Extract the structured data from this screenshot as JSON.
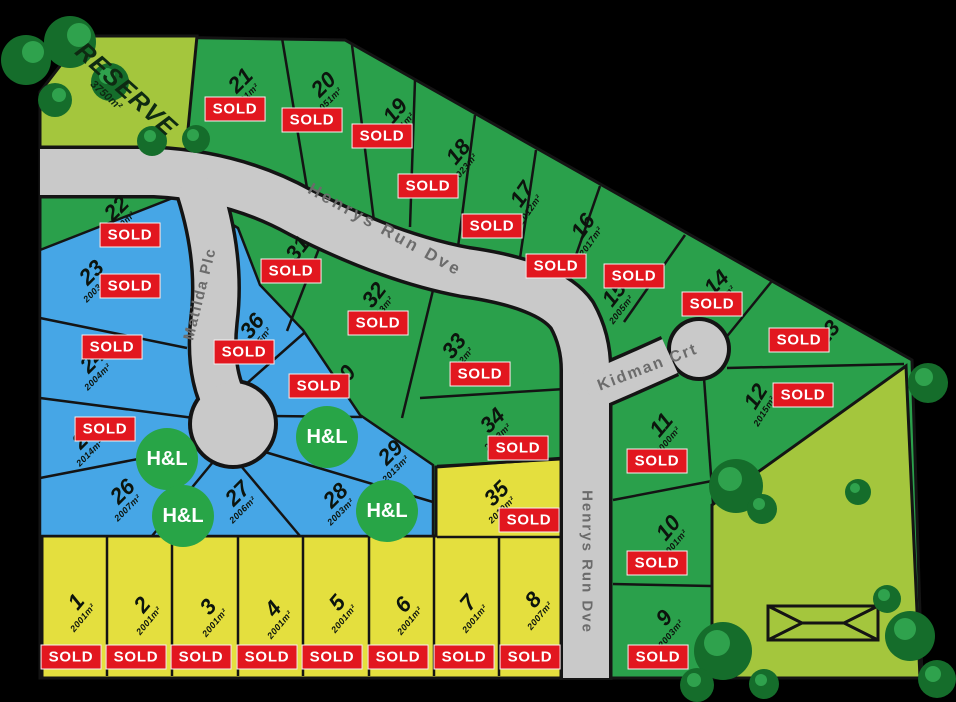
{
  "map": {
    "background": "#000000",
    "colors": {
      "green_lot": "#2aa04b",
      "blue_lot": "#46a6e6",
      "yellow_lot": "#e4df3e",
      "reserve_green": "#a4c63d",
      "road_gray": "#c9c9c9",
      "sold_red": "#e2171f",
      "hl_green": "#28a547"
    },
    "reserve": {
      "label": "RESERVE",
      "area": "3750m²"
    },
    "roads": [
      {
        "name": "Henrys Run Dve"
      },
      {
        "name": "Matilda Plc"
      },
      {
        "name": "Kidman Crt"
      },
      {
        "name": "Henrys Run Dve"
      }
    ],
    "badges": {
      "sold_label": "SOLD",
      "hl_label": "H&L"
    },
    "lots": [
      {
        "num": "1",
        "area": "2001m²",
        "zone": "yellow",
        "sold": true,
        "label": {
          "x": 80,
          "y": 605,
          "rot": -50
        },
        "sold_badge": {
          "x": 71,
          "y": 657
        }
      },
      {
        "num": "2",
        "area": "2001m²",
        "zone": "yellow",
        "sold": true,
        "label": {
          "x": 146,
          "y": 608,
          "rot": -50
        },
        "sold_badge": {
          "x": 136,
          "y": 657
        }
      },
      {
        "num": "3",
        "area": "2001m²",
        "zone": "yellow",
        "sold": true,
        "label": {
          "x": 212,
          "y": 610,
          "rot": -50
        },
        "sold_badge": {
          "x": 201,
          "y": 657
        }
      },
      {
        "num": "4",
        "area": "2001m²",
        "zone": "yellow",
        "sold": true,
        "label": {
          "x": 277,
          "y": 612,
          "rot": -50
        },
        "sold_badge": {
          "x": 267,
          "y": 657
        }
      },
      {
        "num": "5",
        "area": "2001m²",
        "zone": "yellow",
        "sold": true,
        "label": {
          "x": 341,
          "y": 606,
          "rot": -50
        },
        "sold_badge": {
          "x": 332,
          "y": 657
        }
      },
      {
        "num": "6",
        "area": "2001m²",
        "zone": "yellow",
        "sold": true,
        "label": {
          "x": 407,
          "y": 608,
          "rot": -50
        },
        "sold_badge": {
          "x": 398,
          "y": 657
        }
      },
      {
        "num": "7",
        "area": "2001m²",
        "zone": "yellow",
        "sold": true,
        "label": {
          "x": 472,
          "y": 606,
          "rot": -50
        },
        "sold_badge": {
          "x": 464,
          "y": 657
        }
      },
      {
        "num": "8",
        "area": "2007m²",
        "zone": "yellow",
        "sold": true,
        "label": {
          "x": 537,
          "y": 603,
          "rot": -50
        },
        "sold_badge": {
          "x": 530,
          "y": 657
        }
      },
      {
        "num": "9",
        "area": "2003m²",
        "zone": "green",
        "sold": true,
        "label": {
          "x": 668,
          "y": 621,
          "rot": -50
        },
        "sold_badge": {
          "x": 658,
          "y": 657
        }
      },
      {
        "num": "10",
        "area": "2001m²",
        "zone": "green",
        "sold": true,
        "label": {
          "x": 672,
          "y": 531,
          "rot": -50
        },
        "sold_badge": {
          "x": 657,
          "y": 563
        }
      },
      {
        "num": "11",
        "area": "2000m²",
        "zone": "green",
        "sold": true,
        "label": {
          "x": 665,
          "y": 428,
          "rot": -50
        },
        "sold_badge": {
          "x": 657,
          "y": 461
        }
      },
      {
        "num": "12",
        "area": "2015m²",
        "zone": "green",
        "sold": true,
        "label": {
          "x": 760,
          "y": 399,
          "rot": -58
        },
        "sold_badge": {
          "x": 803,
          "y": 395
        }
      },
      {
        "num": "13",
        "area": null,
        "zone": "green",
        "sold": true,
        "label": {
          "x": 828,
          "y": 333,
          "rot": -50
        },
        "sold_badge": {
          "x": 799,
          "y": 340
        }
      },
      {
        "num": "14",
        "area": "2003m²",
        "zone": "green",
        "sold": true,
        "label": {
          "x": 720,
          "y": 286,
          "rot": -45
        },
        "sold_badge": {
          "x": 712,
          "y": 304
        }
      },
      {
        "num": "15",
        "area": "2005m²",
        "zone": "green",
        "sold": true,
        "label": {
          "x": 618,
          "y": 297,
          "rot": -52
        },
        "sold_badge": {
          "x": 634,
          "y": 276
        }
      },
      {
        "num": "16",
        "area": "2017m²",
        "zone": "green",
        "sold": true,
        "label": {
          "x": 587,
          "y": 229,
          "rot": -55
        },
        "sold_badge": {
          "x": 556,
          "y": 266
        }
      },
      {
        "num": "17",
        "area": "2012m²",
        "zone": "green",
        "sold": true,
        "label": {
          "x": 526,
          "y": 197,
          "rot": -55
        },
        "sold_badge": {
          "x": 492,
          "y": 226
        }
      },
      {
        "num": "18",
        "area": "2023m²",
        "zone": "green",
        "sold": true,
        "label": {
          "x": 462,
          "y": 155,
          "rot": -50
        },
        "sold_badge": {
          "x": 428,
          "y": 186
        }
      },
      {
        "num": "19",
        "area": "2021m²",
        "zone": "green",
        "sold": true,
        "label": {
          "x": 399,
          "y": 114,
          "rot": -50
        },
        "sold_badge": {
          "x": 382,
          "y": 136
        }
      },
      {
        "num": "20",
        "area": "2051m²",
        "zone": "green",
        "sold": true,
        "label": {
          "x": 327,
          "y": 88,
          "rot": -45
        },
        "sold_badge": {
          "x": 312,
          "y": 120
        }
      },
      {
        "num": "21",
        "area": "2001m²",
        "zone": "green",
        "sold": true,
        "label": {
          "x": 244,
          "y": 84,
          "rot": -45
        },
        "sold_badge": {
          "x": 235,
          "y": 109
        }
      },
      {
        "num": "22",
        "area": "2010m²",
        "zone": "green",
        "sold": true,
        "label": {
          "x": 120,
          "y": 212,
          "rot": -45
        },
        "sold_badge": {
          "x": 130,
          "y": 235
        }
      },
      {
        "num": "23",
        "area": "2003m²",
        "zone": "blue",
        "sold": true,
        "label": {
          "x": 95,
          "y": 276,
          "rot": -45
        },
        "sold_badge": {
          "x": 130,
          "y": 286
        }
      },
      {
        "num": "24",
        "area": "2004m²",
        "zone": "blue",
        "sold": true,
        "label": {
          "x": 96,
          "y": 364,
          "rot": -45
        },
        "sold_badge": {
          "x": 112,
          "y": 347
        }
      },
      {
        "num": "25",
        "area": "2014m²",
        "zone": "blue",
        "sold": true,
        "label": {
          "x": 88,
          "y": 440,
          "rot": -45
        },
        "sold_badge": {
          "x": 105,
          "y": 429
        }
      },
      {
        "num": "26",
        "area": "2007m²",
        "zone": "blue",
        "sold": false,
        "label": {
          "x": 126,
          "y": 495,
          "rot": -45
        },
        "sold_badge": null
      },
      {
        "num": "27",
        "area": "2006m²",
        "zone": "blue",
        "sold": false,
        "label": {
          "x": 241,
          "y": 497,
          "rot": -45
        },
        "sold_badge": null
      },
      {
        "num": "28",
        "area": "2003m²",
        "zone": "blue",
        "sold": false,
        "label": {
          "x": 339,
          "y": 499,
          "rot": -45
        },
        "sold_badge": null
      },
      {
        "num": "29",
        "area": "2013m²",
        "zone": "blue",
        "sold": false,
        "label": {
          "x": 394,
          "y": 456,
          "rot": -45
        },
        "sold_badge": null
      },
      {
        "num": "30",
        "area": null,
        "zone": "blue",
        "sold": true,
        "label": {
          "x": 344,
          "y": 378,
          "rot": -52
        },
        "sold_badge": {
          "x": 319,
          "y": 386
        }
      },
      {
        "num": "31",
        "area": null,
        "zone": "green",
        "sold": true,
        "label": {
          "x": 298,
          "y": 249,
          "rot": -52
        },
        "sold_badge": {
          "x": 291,
          "y": 271
        }
      },
      {
        "num": "32",
        "area": "2013m²",
        "zone": "green",
        "sold": true,
        "label": {
          "x": 378,
          "y": 298,
          "rot": -52
        },
        "sold_badge": {
          "x": 378,
          "y": 323
        }
      },
      {
        "num": "33",
        "area": "2012m²",
        "zone": "green",
        "sold": true,
        "label": {
          "x": 458,
          "y": 349,
          "rot": -52
        },
        "sold_badge": {
          "x": 480,
          "y": 374
        }
      },
      {
        "num": "34",
        "area": "2013m²",
        "zone": "green",
        "sold": true,
        "label": {
          "x": 496,
          "y": 424,
          "rot": -45
        },
        "sold_badge": {
          "x": 518,
          "y": 448
        }
      },
      {
        "num": "35",
        "area": "2010m²",
        "zone": "yellow",
        "sold": true,
        "label": {
          "x": 500,
          "y": 497,
          "rot": -45
        },
        "sold_badge": {
          "x": 529,
          "y": 520
        }
      },
      {
        "num": "36",
        "area": "2005m²",
        "zone": "blue",
        "sold": true,
        "label": {
          "x": 256,
          "y": 329,
          "rot": -52
        },
        "sold_badge": {
          "x": 244,
          "y": 352
        }
      }
    ],
    "hl_badges": [
      {
        "x": 167,
        "y": 459
      },
      {
        "x": 183,
        "y": 516
      },
      {
        "x": 327,
        "y": 437
      },
      {
        "x": 387,
        "y": 511
      }
    ]
  }
}
